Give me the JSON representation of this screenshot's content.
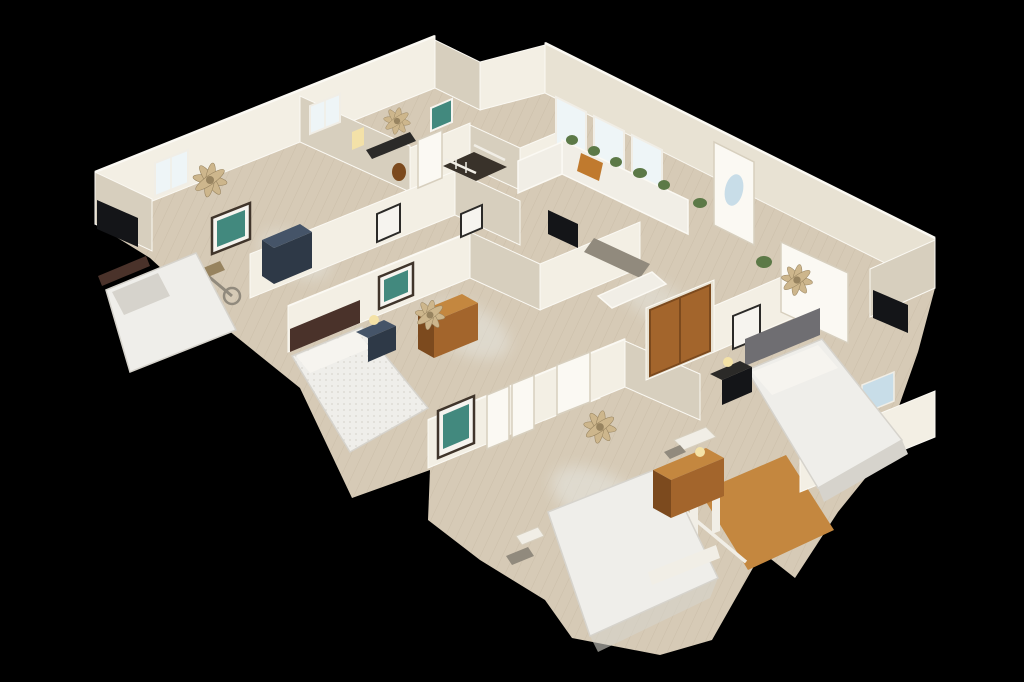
{
  "scene": {
    "type": "3d-dollhouse-view",
    "description": "Overhead cutaway dollhouse view of a single-story home interior (3D scan) floating on a black background, seen from above at an oblique angle",
    "rooms": [
      {
        "name": "master-bedroom",
        "position": "left",
        "items": [
          "window",
          "ceiling-fan",
          "teal-painting",
          "navy-dresser",
          "exercise-bike",
          "wall-tv",
          "bed-with-light-bedding"
        ]
      },
      {
        "name": "office-bedroom",
        "position": "top-left",
        "items": [
          "window",
          "ceiling-fan",
          "dark-desk",
          "warm-lamp",
          "teal-art",
          "white-door"
        ]
      },
      {
        "name": "hallway-and-stairwell",
        "position": "center",
        "items": [
          "dark-stairs",
          "white-railing",
          "picture-frames"
        ]
      },
      {
        "name": "kitchen",
        "position": "top-right",
        "items": [
          "bright-windows",
          "white-cabinets",
          "plants-on-cabinets",
          "microwave",
          "island",
          "orange-window-seat-cushion",
          "front-door-with-oval-glass"
        ]
      },
      {
        "name": "right-bedroom",
        "position": "right",
        "items": [
          "wood-closet-doors",
          "ceiling-fan",
          "gray-headboard-bed",
          "dark-nightstand",
          "white-exterior-door",
          "tv-niche",
          "framed-art"
        ]
      },
      {
        "name": "center-bedroom",
        "position": "center-left",
        "items": [
          "patterned-bed",
          "brown-headboard",
          "nightstand-with-lamp",
          "wood-dresser",
          "teal-painting",
          "ceiling-fan"
        ]
      },
      {
        "name": "bottom-bedroom",
        "position": "bottom",
        "items": [
          "white-bed",
          "wood-chest",
          "sewing-desk-and-chair",
          "teal-painting",
          "white-double-doors",
          "ceiling-fan",
          "stair-opening-with-railing"
        ]
      }
    ],
    "counts": {
      "ceiling_fans": 5,
      "beds": 4,
      "teal_artworks": 4,
      "visible_doors": 8
    }
  },
  "colors": {
    "background": "#000000",
    "wall": "#e8e2d3",
    "wall_lit": "#f3efe4",
    "wall_shadow": "#d7cfbe",
    "wall_edge": "#fbf9f3",
    "floor": "#d6cab6",
    "floor_stripe": "#c2b49e",
    "wood": "#a3652c",
    "wood_light": "#c4873f",
    "wood_dark": "#7c4a1e",
    "navy": "#2e3947",
    "navy_light": "#455468",
    "dark": "#2b2a28",
    "tv": "#141518",
    "bed_white": "#efeeea",
    "bed_shade": "#d6d3cc",
    "headboard_gray": "#6f6e72",
    "headboard_brown": "#4a322a",
    "fan": "#cdb68c",
    "fan_dark": "#97835f",
    "green": "#5c7947",
    "window": "#c8dde8",
    "window_bright": "#eef5f7",
    "glow": "#f4e2a6",
    "cushion": "#c07a2e",
    "stair": "#39322a",
    "railing": "#f1eee6",
    "metal": "#918a7d",
    "art_teal": "#42897e",
    "art_frame": "#40352b",
    "art_mat": "#f6f4ef"
  }
}
